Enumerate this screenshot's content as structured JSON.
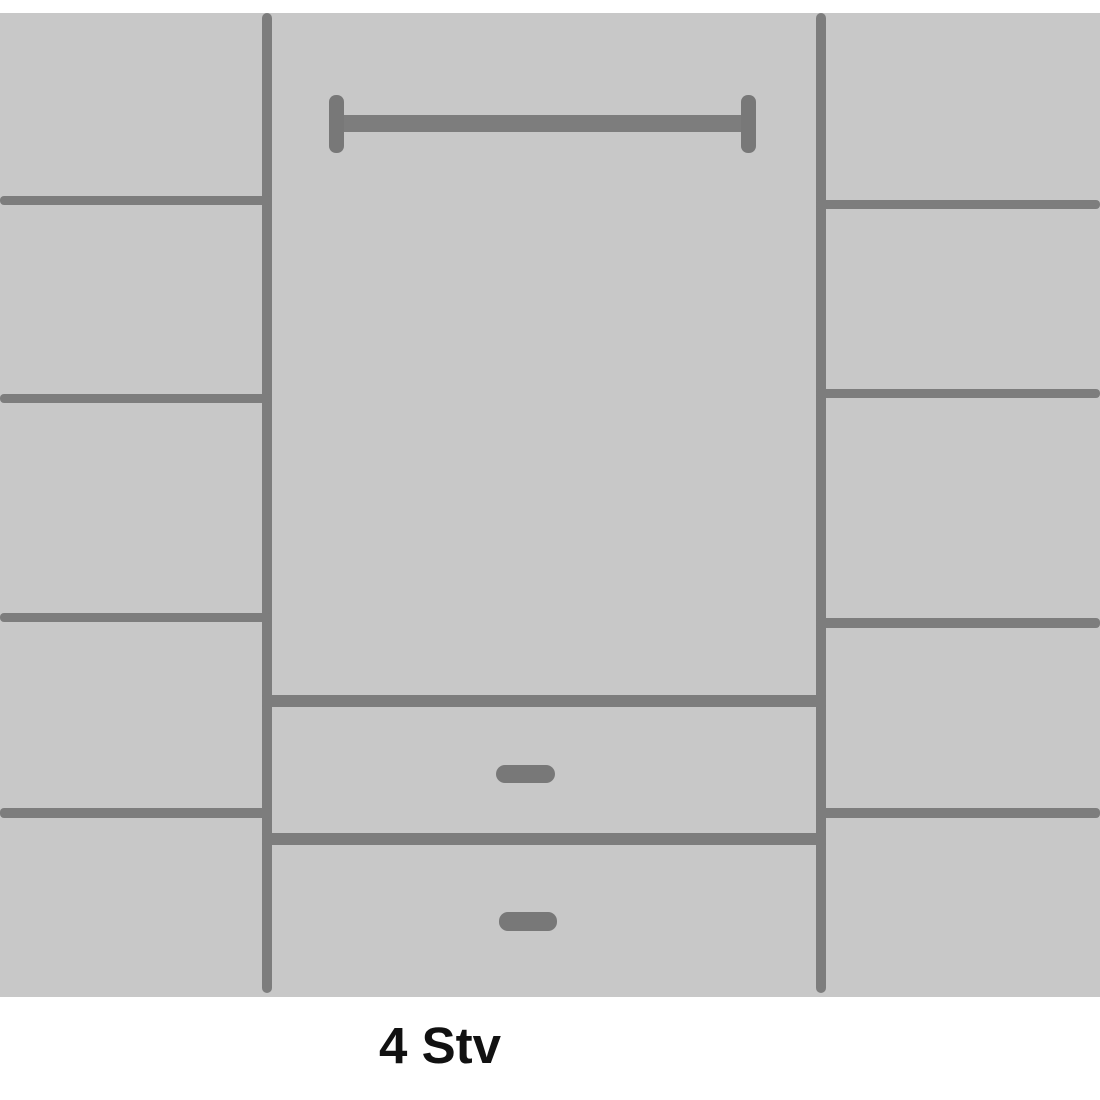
{
  "page": {
    "background": "#ffffff"
  },
  "diagram": {
    "type": "wardrobe-front-schematic",
    "label": "4 Stv",
    "colors": {
      "body": "#c8c8c8",
      "line": "#7d7d7d",
      "fitting": "#787878",
      "label_text": "#111111",
      "page_bg": "#ffffff"
    },
    "canvas": {
      "width": 1100,
      "height": 1100
    },
    "body": {
      "x": 0,
      "y": 13,
      "w": 1100,
      "h": 984
    },
    "components": [
      {
        "name": "divider-panel-left",
        "kind": "line",
        "x": 262,
        "y": 13,
        "w": 10,
        "h": 980,
        "r": 5
      },
      {
        "name": "divider-panel-right",
        "kind": "line",
        "x": 816,
        "y": 13,
        "w": 10,
        "h": 980,
        "r": 5
      },
      {
        "name": "left-shelf-line-1",
        "kind": "line",
        "x": 0,
        "y": 196,
        "w": 271,
        "h": 9,
        "r": 4
      },
      {
        "name": "left-shelf-line-2",
        "kind": "line",
        "x": 0,
        "y": 394,
        "w": 271,
        "h": 9,
        "r": 4
      },
      {
        "name": "left-shelf-line-3",
        "kind": "line",
        "x": 0,
        "y": 613,
        "w": 271,
        "h": 9,
        "r": 4
      },
      {
        "name": "left-shelf-line-4",
        "kind": "line",
        "x": 0,
        "y": 808,
        "w": 271,
        "h": 10,
        "r": 4
      },
      {
        "name": "right-shelf-line-1",
        "kind": "line",
        "x": 816,
        "y": 200,
        "w": 284,
        "h": 9,
        "r": 4
      },
      {
        "name": "right-shelf-line-2",
        "kind": "line",
        "x": 816,
        "y": 389,
        "w": 284,
        "h": 9,
        "r": 4
      },
      {
        "name": "right-shelf-line-3",
        "kind": "line",
        "x": 816,
        "y": 618,
        "w": 284,
        "h": 10,
        "r": 4
      },
      {
        "name": "right-shelf-line-4",
        "kind": "line",
        "x": 816,
        "y": 808,
        "w": 284,
        "h": 10,
        "r": 4
      },
      {
        "name": "clothes-rail-bar",
        "kind": "rail",
        "x": 336,
        "y": 115,
        "w": 412,
        "h": 17,
        "r": 2
      },
      {
        "name": "clothes-rail-end-left",
        "kind": "fitting",
        "x": 329,
        "y": 95,
        "w": 15,
        "h": 58,
        "r": 7
      },
      {
        "name": "clothes-rail-end-right",
        "kind": "fitting",
        "x": 741,
        "y": 95,
        "w": 15,
        "h": 58,
        "r": 7
      },
      {
        "name": "drawer-top-edge-line",
        "kind": "line",
        "x": 262,
        "y": 695,
        "w": 564,
        "h": 12,
        "r": 2
      },
      {
        "name": "drawer-separator-line",
        "kind": "line",
        "x": 262,
        "y": 833,
        "w": 564,
        "h": 12,
        "r": 2
      },
      {
        "name": "drawer-handle-top",
        "kind": "fitting",
        "x": 496,
        "y": 765,
        "w": 59,
        "h": 18,
        "r": 9
      },
      {
        "name": "drawer-handle-bottom",
        "kind": "fitting",
        "x": 499,
        "y": 912,
        "w": 58,
        "h": 19,
        "r": 9
      }
    ]
  }
}
